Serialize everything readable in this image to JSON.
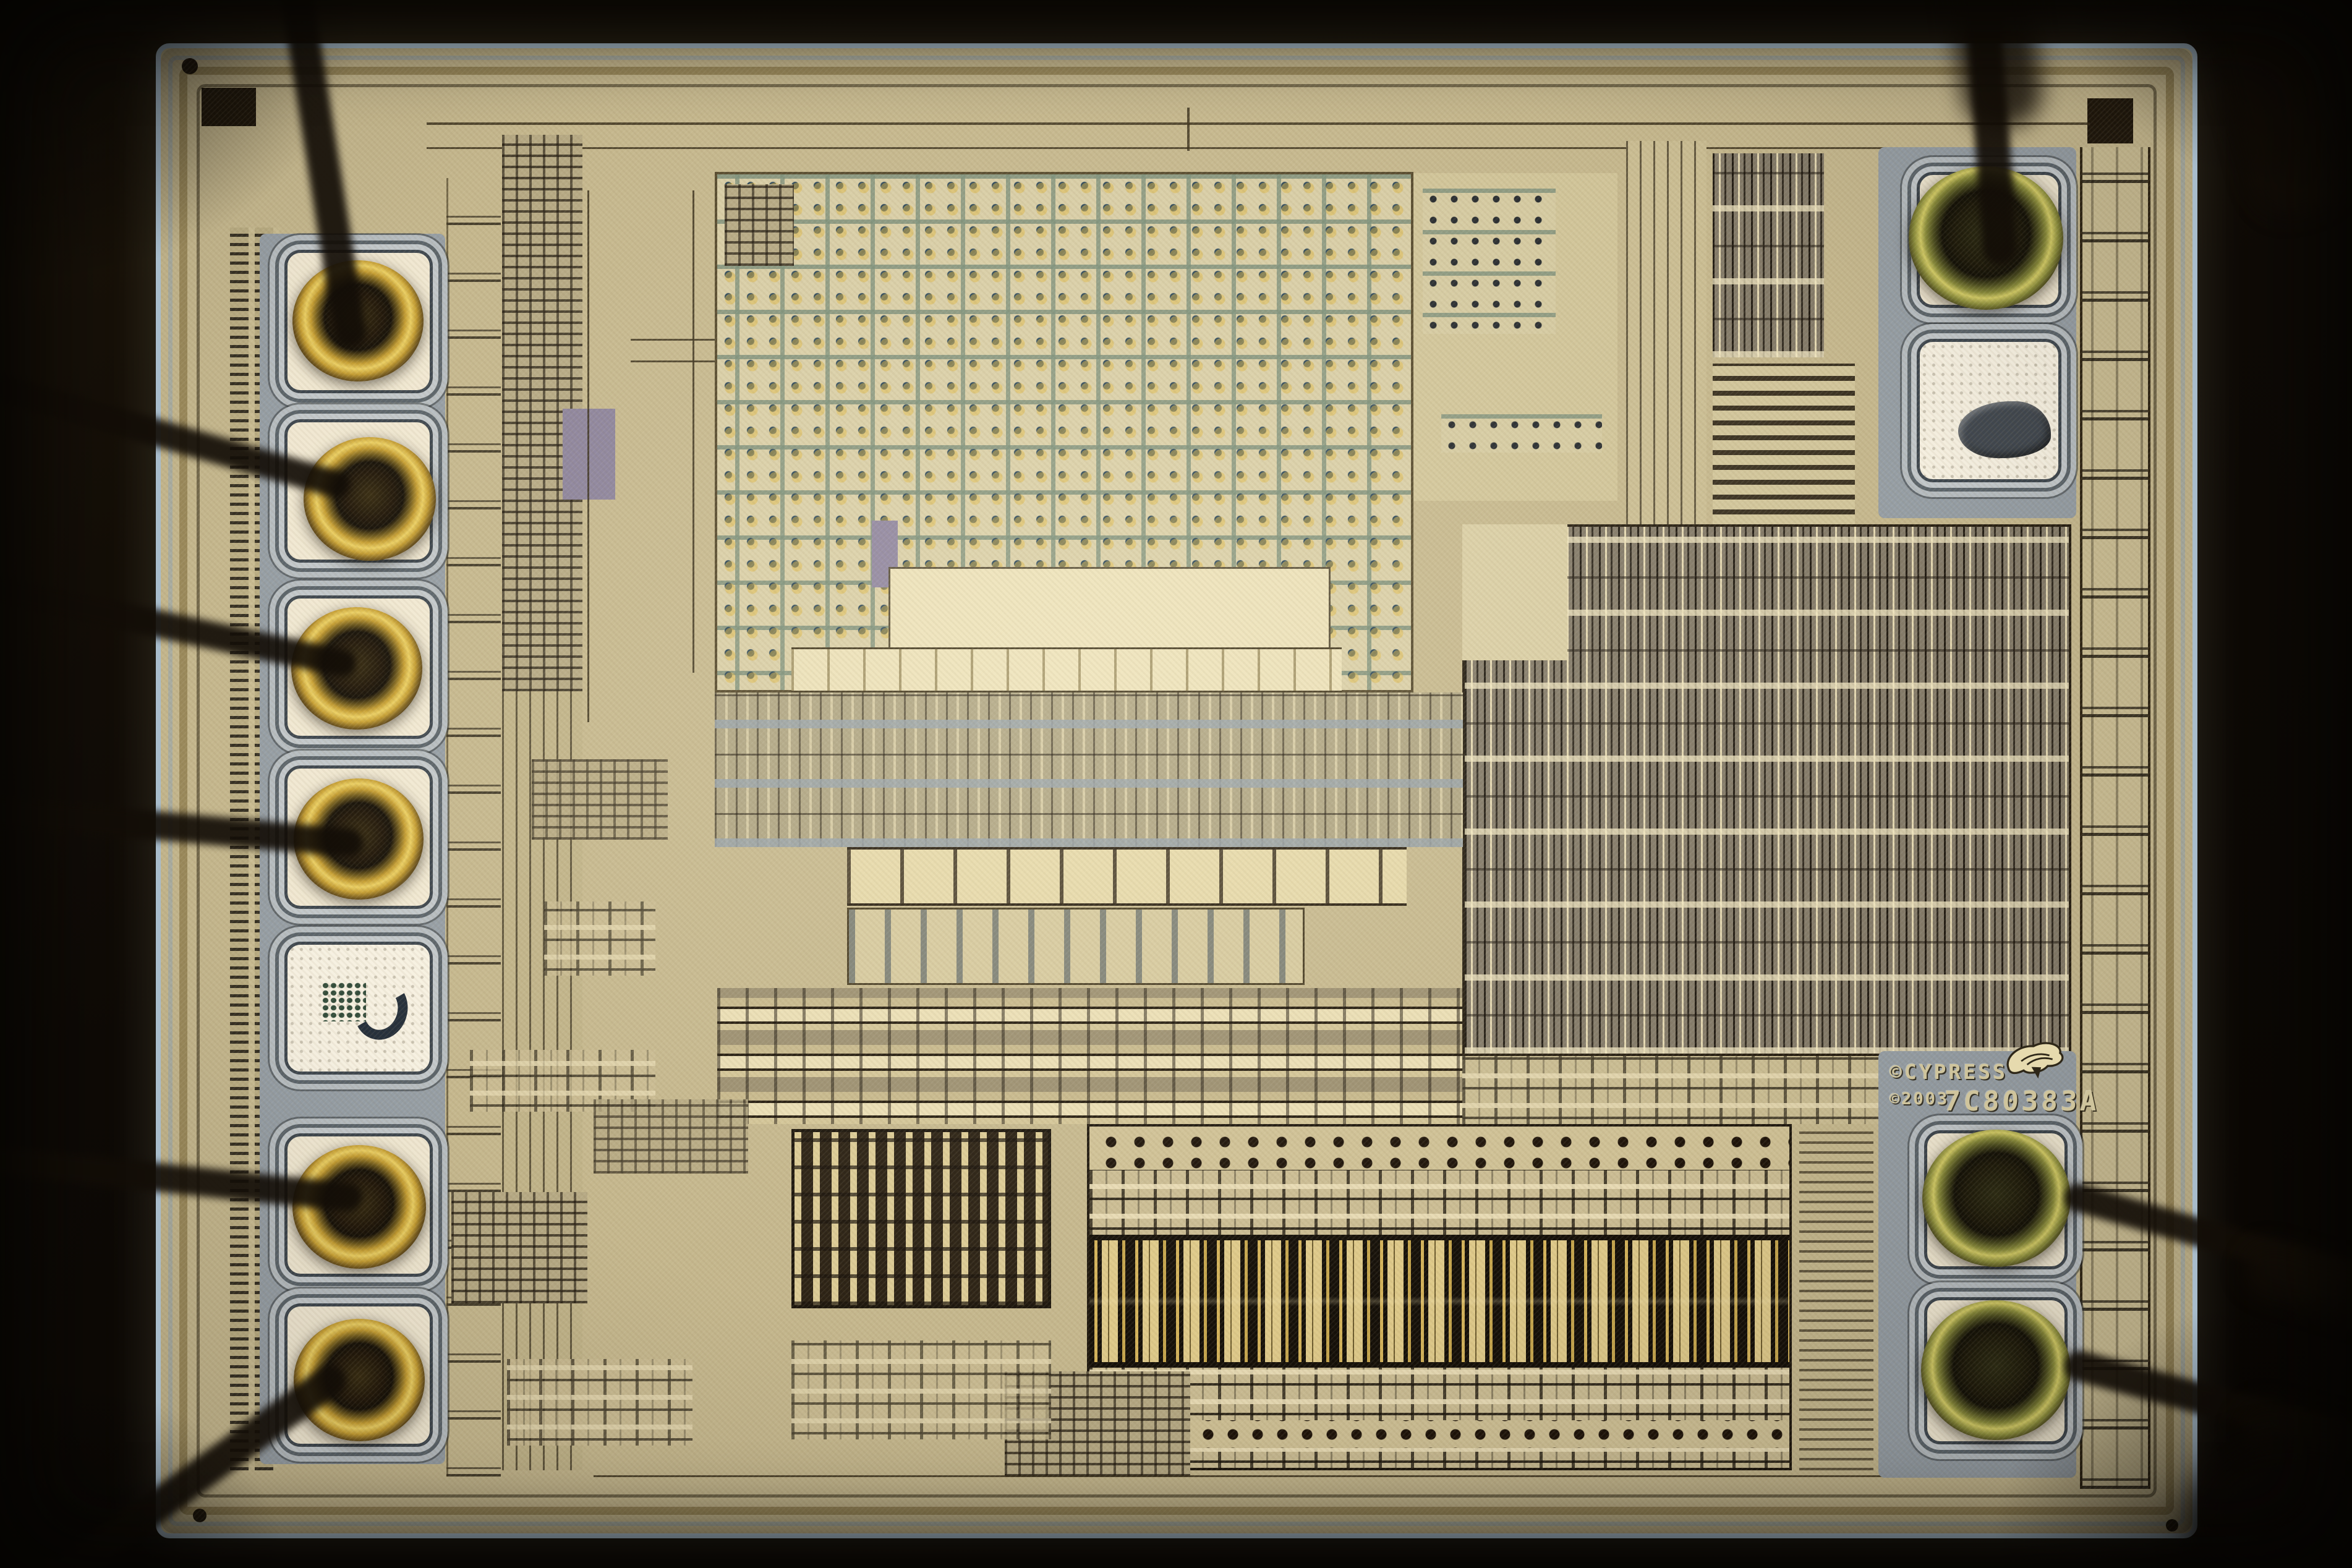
{
  "meta": {
    "description": "Photomicrograph of a Cypress Semiconductor integrated-circuit die with gold ball bonds and attached bond wires",
    "visible_text_items": 3
  },
  "die_markings": {
    "brand_line": "©CYPRESS",
    "year_line": "©2003",
    "part_number": "7C80383A",
    "logo": "cypress-tree-logo"
  },
  "bond_pads": {
    "left_column_total": 7,
    "left_column_bonded": 6,
    "left_column_empty": 1,
    "top_right_total": 2,
    "top_right_bonded": 1,
    "top_right_empty": 1,
    "bottom_right_total": 2,
    "bottom_right_bonded": 2,
    "bond_wires_visible": 10
  },
  "regions": {
    "capacitor_array": "decoupling-capacitor array (dot grid)",
    "standard_cell_logic": "standard-cell digital logic block",
    "analog_block": "analog circuitry rows",
    "output_driver_array": "output driver slot array",
    "comb_block": "comb-finger structure",
    "io_columns": "I/O cell columns",
    "seal_ring": "die seal ring",
    "corner_marks": "die corner alignment marks"
  },
  "colors": {
    "tan": "#c9bc92",
    "tan-light": "#ddd2a9",
    "tan-dark": "#a89a6e",
    "cream": "#efe4bd",
    "array-bg": "#dcd2ab",
    "array-dot": "#27455c",
    "pad-fill": "#f7efda",
    "pad-empty": "#fdf8ea",
    "pad-ring": "#c6cdd2",
    "pad-line": "#3c4650",
    "pad-zone": "#97a1aa",
    "logic-gray": "#847c6c",
    "channel-blue": "#9aa5ad",
    "purple": "#8e85a0",
    "seal-blue": "#a8bccb",
    "gold": "#d8ad38",
    "text-engrave": "#cfc49c",
    "background": "#0e0a06"
  }
}
